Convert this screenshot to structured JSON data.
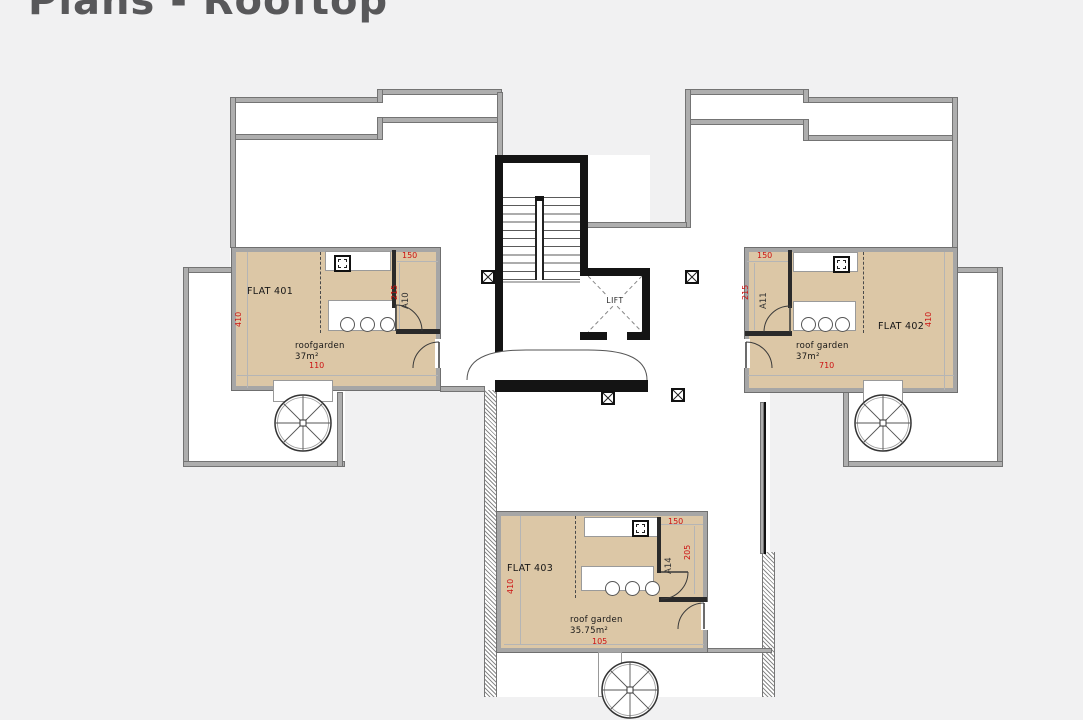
{
  "page": {
    "title": "Plans - Rooftop"
  },
  "colors": {
    "background": "#f1f1f2",
    "flat_fill": "#dcc7a6",
    "parapet_gray": "#aeaeae",
    "core_black": "#141414",
    "dimension_red": "#cc1111"
  },
  "core": {
    "lift_label": "LIFT"
  },
  "flats": [
    {
      "name": "FLAT 401",
      "garden_line1": "roofgarden",
      "garden_line2": "37m²",
      "room": "A10",
      "dim_top": "150",
      "dim_side": "215",
      "dim_bottom": "110",
      "dim_outer": "410"
    },
    {
      "name": "FLAT 402",
      "garden_line1": "roof garden",
      "garden_line2": "37m²",
      "room": "A11",
      "dim_top": "150",
      "dim_side": "215",
      "dim_bottom": "710",
      "dim_outer": "410"
    },
    {
      "name": "FLAT 403",
      "garden_line1": "roof garden",
      "garden_line2": "35.75m²",
      "room": "A14",
      "dim_top": "150",
      "dim_side": "205",
      "dim_bottom": "105",
      "dim_outer": "410"
    }
  ]
}
